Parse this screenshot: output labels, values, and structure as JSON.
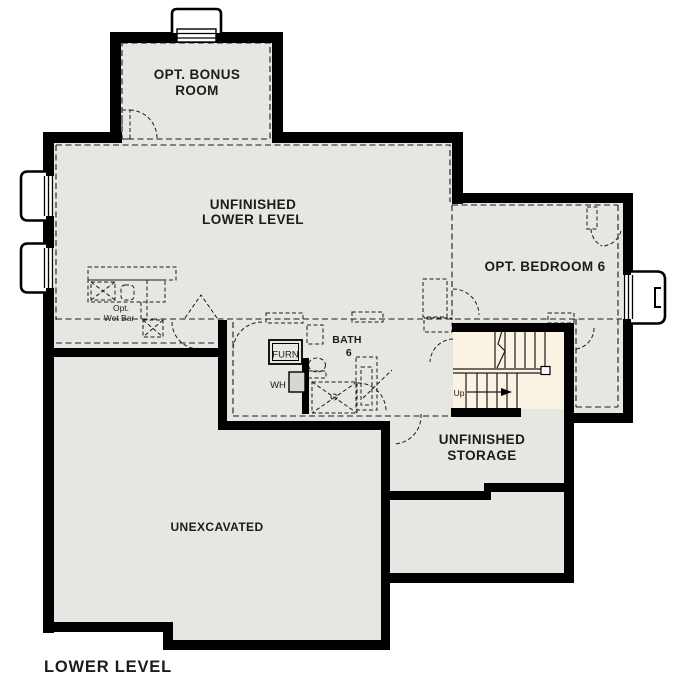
{
  "plan": {
    "title": "LOWER LEVEL",
    "rooms": {
      "bonus": {
        "line1": "OPT. BONUS",
        "line2": "ROOM"
      },
      "main": {
        "line1": "UNFINISHED",
        "line2": "LOWER LEVEL"
      },
      "bedroom": {
        "label": "OPT. BEDROOM 6"
      },
      "bath": {
        "line1": "BATH",
        "line2": "6"
      },
      "storage": {
        "line1": "UNFINISHED",
        "line2": "STORAGE"
      },
      "unexcavated": {
        "label": "UNEXCAVATED"
      }
    },
    "fixtures": {
      "furnace": "FURN",
      "water_heater": "WH",
      "wet_bar": {
        "line1": "Opt.",
        "line2": "Wet Bar"
      },
      "stairs_up": "Up"
    },
    "colors": {
      "floor": "#e8e6e2",
      "stairs": "#faf2e2",
      "wall": "#000000",
      "text": "#1c1c1c",
      "appliance": "#d8d6d2"
    }
  }
}
